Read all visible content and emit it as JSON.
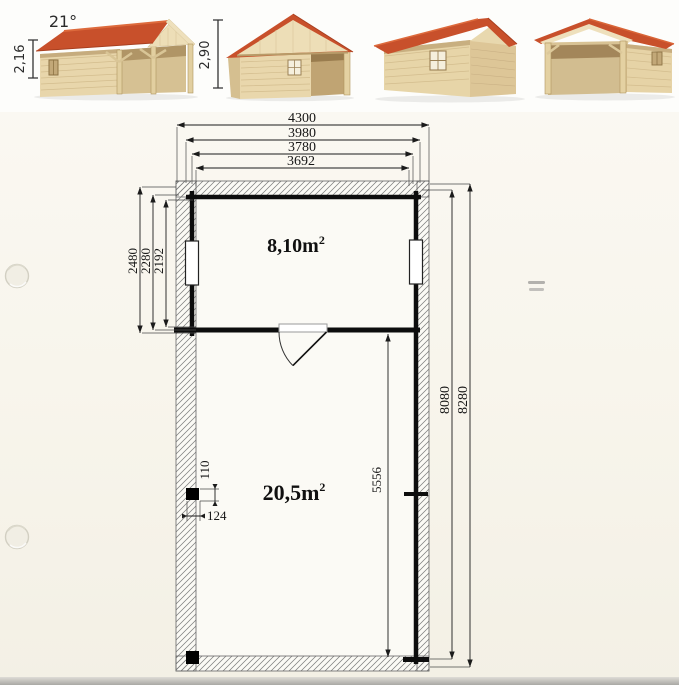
{
  "photos": {
    "roof_angle": "21°",
    "wall_height": "2,16",
    "ridge_height": "2,90"
  },
  "floor_plan": {
    "dims_top": [
      "4300",
      "3980",
      "3780",
      "3692"
    ],
    "dims_left": [
      "2480",
      "2280",
      "2192"
    ],
    "dims_right": [
      "8080",
      "8280"
    ],
    "dim_inner": "5556",
    "post_dims": [
      "110",
      "124"
    ],
    "rooms": [
      {
        "area": "8,10m",
        "sup": "2"
      },
      {
        "area": "20,5m",
        "sup": "2"
      }
    ]
  },
  "colors": {
    "roof_red": "#c8502b",
    "roof_red_dark": "#a83f1f",
    "wall_tan": "#e8d6ab",
    "wall_tan_shaded": "#d8c294",
    "shadow_brown": "#a98d5e",
    "paper": "#f8f5ec",
    "ink": "#161616"
  }
}
